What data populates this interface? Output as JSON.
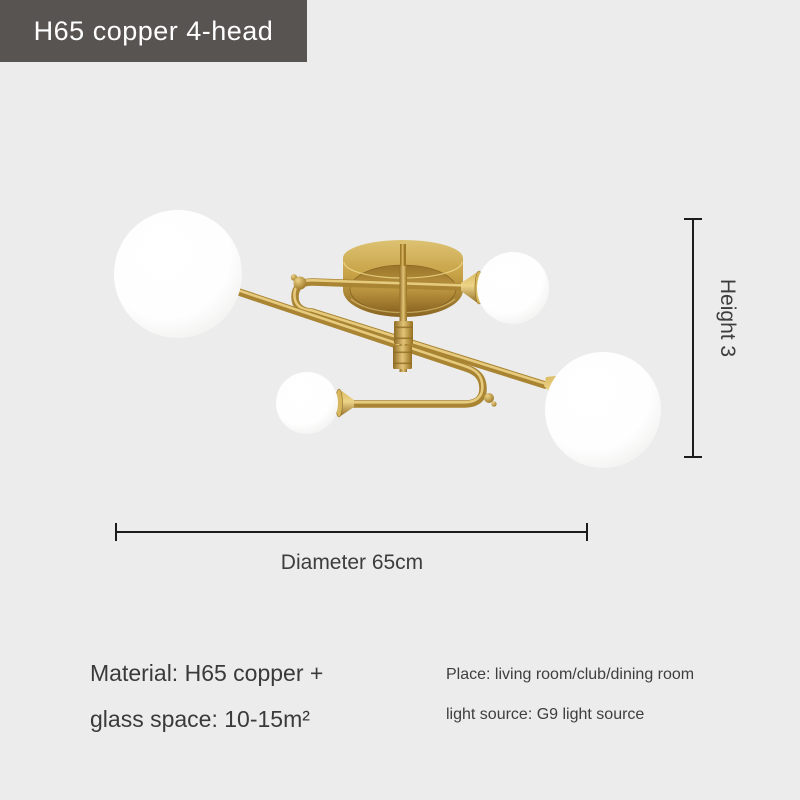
{
  "page": {
    "background": "#ebeceb"
  },
  "banner": {
    "label": "H65 copper 4-head",
    "background": "#585451",
    "text_color": "#ffffff"
  },
  "product": {
    "illustration": "brass-4-globe-ceiling-lamp",
    "head_count": 4,
    "brass_color": "#c7a246",
    "globe_color": "#ffffff"
  },
  "dimensions": {
    "height_label": "Height 3",
    "diameter_label": "Diameter 65cm",
    "line_color": "#1c1c1c"
  },
  "specs": {
    "material_line1": "Material: H65 copper +",
    "material_line2": "glass space: 10-15m²",
    "place_line1": "Place: living room/club/dining room",
    "place_line2": "light source: G9 light source"
  }
}
